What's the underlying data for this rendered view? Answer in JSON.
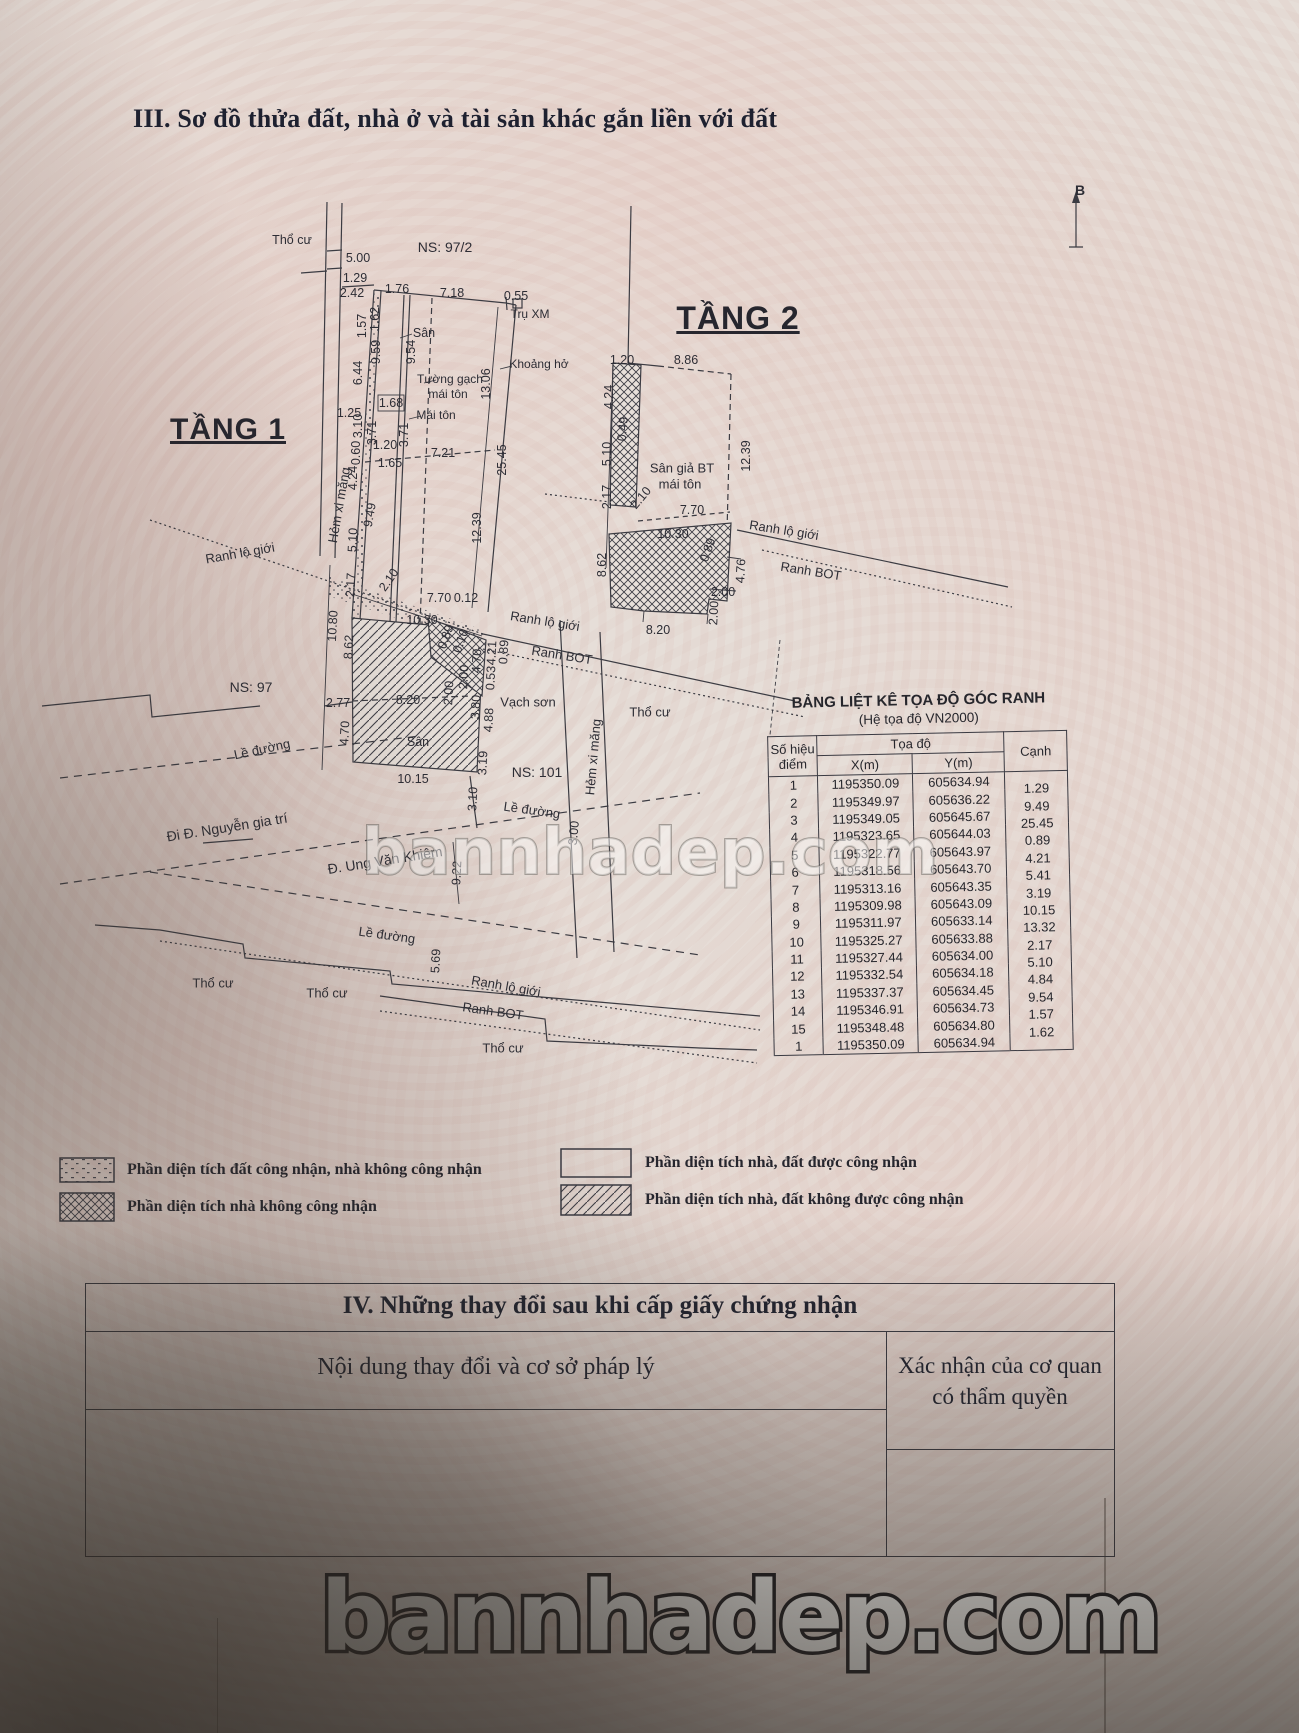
{
  "page_title": "III. Sơ đồ thửa đất, nhà ở và tài sản khác gắn liền với đất",
  "watermarks": {
    "middle": "bannhadep.com",
    "bottom": "bannhadep.com"
  },
  "coord_table": {
    "title": "BẢNG LIỆT KÊ TỌA ĐỘ GÓC RANH",
    "subtitle": "(Hệ tọa độ VN2000)",
    "col_point_l1": "Số hiệu",
    "col_point_l2": "điểm",
    "col_coord": "Tọa độ",
    "col_x": "X(m)",
    "col_y": "Y(m)",
    "col_edge": "Cạnh",
    "rows": [
      {
        "id": "1",
        "x": "1195350.09",
        "y": "605634.94"
      },
      {
        "id": "2",
        "x": "1195349.97",
        "y": "605636.22"
      },
      {
        "id": "3",
        "x": "1195349.05",
        "y": "605645.67"
      },
      {
        "id": "4",
        "x": "1195323.65",
        "y": "605644.03"
      },
      {
        "id": "5",
        "x": "1195322.77",
        "y": "605643.97"
      },
      {
        "id": "6",
        "x": "1195318.56",
        "y": "605643.70"
      },
      {
        "id": "7",
        "x": "1195313.16",
        "y": "605643.35"
      },
      {
        "id": "8",
        "x": "1195309.98",
        "y": "605643.09"
      },
      {
        "id": "9",
        "x": "1195311.97",
        "y": "605633.14"
      },
      {
        "id": "10",
        "x": "1195325.27",
        "y": "605633.88"
      },
      {
        "id": "11",
        "x": "1195327.44",
        "y": "605634.00"
      },
      {
        "id": "12",
        "x": "1195332.54",
        "y": "605634.18"
      },
      {
        "id": "13",
        "x": "1195337.37",
        "y": "605634.45"
      },
      {
        "id": "14",
        "x": "1195346.91",
        "y": "605634.73"
      },
      {
        "id": "15",
        "x": "1195348.48",
        "y": "605634.80"
      },
      {
        "id": "1",
        "x": "1195350.09",
        "y": "605634.94"
      }
    ],
    "edges": [
      "1.29",
      "9.49",
      "25.45",
      "0.89",
      "4.21",
      "5.41",
      "3.19",
      "10.15",
      "13.32",
      "2.17",
      "5.10",
      "4.84",
      "9.54",
      "1.57",
      "1.62"
    ]
  },
  "legend": [
    {
      "pattern": "speckle",
      "label": "Phần diện tích đất công nhận, nhà không công nhận",
      "x": 59,
      "y": 1157,
      "w": 56,
      "h": 26,
      "lx": 127
    },
    {
      "pattern": "xhatch",
      "label": "Phần diện tích nhà không công nhận",
      "x": 59,
      "y": 1192,
      "w": 56,
      "h": 30,
      "lx": 127
    },
    {
      "pattern": "plain",
      "label": "Phần diện tích nhà, đất được công nhận",
      "x": 560,
      "y": 1148,
      "w": 72,
      "h": 30,
      "lx": 645
    },
    {
      "pattern": "dhatch",
      "label": "Phần diện tích nhà, đất không được công nhận",
      "x": 560,
      "y": 1184,
      "w": 72,
      "h": 32,
      "lx": 645
    }
  ],
  "section4": {
    "title": "IV. Những thay đổi sau khi cấp giấy chứng nhận",
    "col_left": "Nội dung thay đổi và cơ sở pháp lý",
    "col_right_l1": "Xác nhận của cơ quan",
    "col_right_l2": "có thẩm quyền"
  },
  "diagram_labels": [
    {
      "t": "Thổ cư",
      "x": 292,
      "y": 240
    },
    {
      "t": "5.00",
      "x": 358,
      "y": 258
    },
    {
      "t": "1.29",
      "x": 355,
      "y": 278
    },
    {
      "t": "2.42",
      "x": 352,
      "y": 293
    },
    {
      "t": "NS: 97/2",
      "x": 445,
      "y": 247,
      "fs": 14
    },
    {
      "t": "1.76",
      "x": 397,
      "y": 289
    },
    {
      "t": "7.18",
      "x": 452,
      "y": 293
    },
    {
      "t": "0.55",
      "x": 516,
      "y": 296
    },
    {
      "t": "Trụ XM",
      "x": 530,
      "y": 314,
      "fs": 12
    },
    {
      "t": "1.62",
      "x": 375,
      "y": 319,
      "r": -90
    },
    {
      "t": "1.57",
      "x": 362,
      "y": 326,
      "r": -90
    },
    {
      "t": "Sân",
      "x": 424,
      "y": 333
    },
    {
      "t": "9.59",
      "x": 376,
      "y": 352,
      "r": -90
    },
    {
      "t": "9.54",
      "x": 411,
      "y": 352,
      "r": -90
    },
    {
      "t": "Khoảng hở",
      "x": 539,
      "y": 364,
      "fs": 12
    },
    {
      "t": "6.44",
      "x": 358,
      "y": 373,
      "r": -90
    },
    {
      "t": "Tường gạch",
      "x": 450,
      "y": 379,
      "fs": 12
    },
    {
      "t": "mái tôn",
      "x": 448,
      "y": 394,
      "fs": 12
    },
    {
      "t": "13.06",
      "x": 486,
      "y": 384,
      "r": -90
    },
    {
      "t": "1.25",
      "x": 349,
      "y": 413
    },
    {
      "t": "1.68",
      "x": 391,
      "y": 403
    },
    {
      "t": "Mái tôn",
      "x": 436,
      "y": 415,
      "fs": 12
    },
    {
      "t": "3.10",
      "x": 358,
      "y": 426,
      "r": -90
    },
    {
      "t": "3.71",
      "x": 372,
      "y": 433,
      "r": -90
    },
    {
      "t": "3.71",
      "x": 404,
      "y": 435,
      "r": -90
    },
    {
      "t": "1.20",
      "x": 385,
      "y": 445
    },
    {
      "t": "7.21",
      "x": 443,
      "y": 453
    },
    {
      "t": "25.45",
      "x": 502,
      "y": 460,
      "r": -90
    },
    {
      "t": "0.60",
      "x": 356,
      "y": 453,
      "r": -90
    },
    {
      "t": "4.24",
      "x": 353,
      "y": 478,
      "r": -90
    },
    {
      "t": "1.65",
      "x": 390,
      "y": 463
    },
    {
      "t": "TẦNG 1",
      "x": 228,
      "y": 430,
      "fs": 30,
      "cls": "floor-title",
      "n": "floor1-title"
    },
    {
      "t": "Hẻm xi măng",
      "x": 339,
      "y": 505,
      "r": -80,
      "fs": 13
    },
    {
      "t": "9.49",
      "x": 370,
      "y": 515,
      "r": -80
    },
    {
      "t": "12.39",
      "x": 477,
      "y": 528,
      "r": -90
    },
    {
      "t": "5.10",
      "x": 353,
      "y": 540,
      "r": -87
    },
    {
      "t": "Ranh lộ giới",
      "x": 240,
      "y": 553,
      "r": -10,
      "fs": 13
    },
    {
      "t": "2.17",
      "x": 351,
      "y": 585,
      "r": -87
    },
    {
      "t": "2.10",
      "x": 389,
      "y": 580,
      "r": -55
    },
    {
      "t": "10.80",
      "x": 333,
      "y": 626,
      "r": -87
    },
    {
      "t": "7.70",
      "x": 439,
      "y": 598
    },
    {
      "t": "0.12",
      "x": 466,
      "y": 598
    },
    {
      "t": "10.30",
      "x": 422,
      "y": 620
    },
    {
      "t": "Ranh lộ giới",
      "x": 545,
      "y": 621,
      "r": 9,
      "fs": 13
    },
    {
      "t": "8.62",
      "x": 349,
      "y": 647,
      "r": -87
    },
    {
      "t": "Ranh BOT",
      "x": 562,
      "y": 655,
      "r": 9,
      "fs": 13
    },
    {
      "t": "0.89",
      "x": 446,
      "y": 637,
      "r": -70
    },
    {
      "t": "0.10",
      "x": 461,
      "y": 641,
      "r": -70
    },
    {
      "t": "4.70",
      "x": 477,
      "y": 661,
      "r": -87
    },
    {
      "t": "4.21",
      "x": 492,
      "y": 653,
      "r": -87
    },
    {
      "t": "0.89",
      "x": 504,
      "y": 652,
      "r": -87
    },
    {
      "t": "0.53",
      "x": 491,
      "y": 678,
      "r": -87
    },
    {
      "t": "2.00",
      "x": 464,
      "y": 677,
      "r": -87
    },
    {
      "t": "2.00",
      "x": 449,
      "y": 693,
      "r": -87
    },
    {
      "t": "NS: 97",
      "x": 251,
      "y": 687,
      "fs": 14
    },
    {
      "t": "2.77",
      "x": 338,
      "y": 703
    },
    {
      "t": "8.20",
      "x": 408,
      "y": 700
    },
    {
      "t": "Vạch sơn",
      "x": 528,
      "y": 702,
      "fs": 13
    },
    {
      "t": "3.80",
      "x": 476,
      "y": 707,
      "r": -87
    },
    {
      "t": "4.88",
      "x": 489,
      "y": 720,
      "r": -87
    },
    {
      "t": "4.70",
      "x": 345,
      "y": 733,
      "r": -87
    },
    {
      "t": "Sân",
      "x": 418,
      "y": 742
    },
    {
      "t": "3.19",
      "x": 483,
      "y": 763,
      "r": -87
    },
    {
      "t": "Lề đường",
      "x": 262,
      "y": 749,
      "r": -12,
      "fs": 13
    },
    {
      "t": "NS: 101",
      "x": 537,
      "y": 772,
      "fs": 14
    },
    {
      "t": "10.15",
      "x": 413,
      "y": 779
    },
    {
      "t": "3.10",
      "x": 473,
      "y": 799,
      "r": -87
    },
    {
      "t": "Lề đường",
      "x": 532,
      "y": 810,
      "r": 8,
      "fs": 13
    },
    {
      "t": "Hẻm xi măng",
      "x": 593,
      "y": 757,
      "r": -85,
      "fs": 13
    },
    {
      "t": "Thổ cư",
      "x": 650,
      "y": 712,
      "fs": 13
    },
    {
      "t": "3.00",
      "x": 574,
      "y": 833,
      "r": -85
    },
    {
      "t": "Đi Đ. Nguyễn gia trí",
      "x": 227,
      "y": 827,
      "r": -9,
      "fs": 14
    },
    {
      "t": "Đ. Ung Văn Khiêm",
      "x": 385,
      "y": 860,
      "r": -9,
      "fs": 14
    },
    {
      "t": "9.22",
      "x": 457,
      "y": 873,
      "r": -87
    },
    {
      "t": "Lề đường",
      "x": 387,
      "y": 935,
      "r": 8,
      "fs": 13
    },
    {
      "t": "5.69",
      "x": 436,
      "y": 961,
      "r": -87
    },
    {
      "t": "Thổ cư",
      "x": 213,
      "y": 983,
      "fs": 13
    },
    {
      "t": "Thổ cư",
      "x": 327,
      "y": 993,
      "fs": 13
    },
    {
      "t": "Ranh lộ giới",
      "x": 506,
      "y": 986,
      "r": 10,
      "fs": 13
    },
    {
      "t": "Ranh BOT",
      "x": 493,
      "y": 1011,
      "r": 8,
      "fs": 13
    },
    {
      "t": "Thổ cư",
      "x": 503,
      "y": 1048,
      "fs": 13
    },
    {
      "t": "TẦNG 2",
      "x": 738,
      "y": 318,
      "fs": 32,
      "cls": "floor-title",
      "n": "floor2-title"
    },
    {
      "t": "1.20",
      "x": 622,
      "y": 360
    },
    {
      "t": "8.86",
      "x": 686,
      "y": 360
    },
    {
      "t": "4.24",
      "x": 609,
      "y": 397,
      "r": -90
    },
    {
      "t": "0.49",
      "x": 623,
      "y": 429,
      "r": -85
    },
    {
      "t": "5.10",
      "x": 607,
      "y": 454,
      "r": -90
    },
    {
      "t": "12.39",
      "x": 746,
      "y": 456,
      "r": -90
    },
    {
      "t": "Sân giả BT",
      "x": 682,
      "y": 468,
      "fs": 13
    },
    {
      "t": "mái tôn",
      "x": 680,
      "y": 484,
      "fs": 13
    },
    {
      "t": "2.17",
      "x": 607,
      "y": 497,
      "r": -90
    },
    {
      "t": "2.10",
      "x": 641,
      "y": 498,
      "r": -50
    },
    {
      "t": "7.70",
      "x": 692,
      "y": 510
    },
    {
      "t": "10.30",
      "x": 673,
      "y": 534
    },
    {
      "t": "Ranh lộ giới",
      "x": 784,
      "y": 530,
      "r": 9,
      "fs": 13
    },
    {
      "t": "Ranh BOT",
      "x": 811,
      "y": 571,
      "r": 9,
      "fs": 13
    },
    {
      "t": "8.62",
      "x": 602,
      "y": 565,
      "r": -90
    },
    {
      "t": "0.89",
      "x": 708,
      "y": 550,
      "r": -70
    },
    {
      "t": "4.76",
      "x": 741,
      "y": 571,
      "r": -87
    },
    {
      "t": "2.00",
      "x": 723,
      "y": 592
    },
    {
      "t": "2.00",
      "x": 714,
      "y": 613,
      "r": -87
    },
    {
      "t": "8.20",
      "x": 658,
      "y": 630
    },
    {
      "t": "B",
      "x": 1080,
      "y": 190,
      "fs": 14,
      "cls": "bold",
      "n": "north-label"
    }
  ]
}
